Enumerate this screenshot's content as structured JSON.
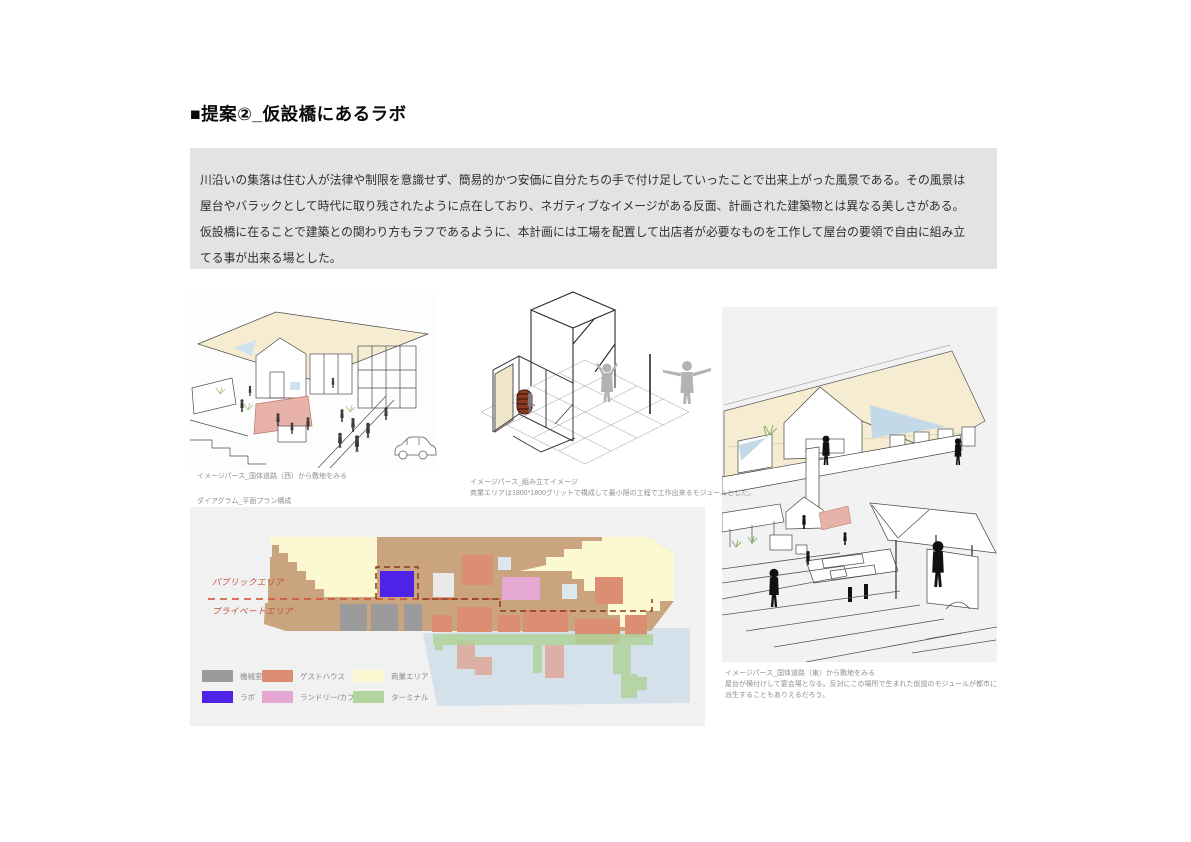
{
  "page": {
    "title": "■提案②_仮設橋にあるラボ"
  },
  "intro": {
    "lines": [
      "川沿いの集落は住む人が法律や制限を意識せず、簡易的かつ安価に自分たちの手で付け足していったことで出来上がった風景である。その風景は",
      "屋台やバラックとして時代に取り残されたように点在しており、ネガティブなイメージがある反面、計画された建築物とは異なる美しさがある。",
      "仮設橋に在ることで建築との関わり方もラフであるように、本計画には工場を配置して出店者が必要なものを工作して屋台の要領で自由に組み立",
      "てる事が出来る場とした。"
    ]
  },
  "views": {
    "west": {
      "caption": "イメージパース_国体道路（西）から敷地をみる"
    },
    "assembly": {
      "caption": "イメージパース_組み立てイメージ",
      "note": "商業エリアは1800*1800グリットで構成して最小限の工程で工作出来るモジュールとした。"
    },
    "east": {
      "caption": "イメージパース_国体道路（東）から敷地をみる",
      "note": "屋台が横付けして宴会場となる。反対にこの場所で生まれた仮設のモジュールが都市に派生することもありえるだろう。"
    }
  },
  "diagram": {
    "caption": "ダイアグラム_平面プラン構成",
    "zones": {
      "public": "パブリックエリア",
      "private": "プライベートエリア"
    },
    "legend": [
      {
        "label": "機械室",
        "color": "#9b9b9b"
      },
      {
        "label": "ゲストハウス",
        "color": "#dc8e72"
      },
      {
        "label": "商業エリア",
        "color": "#fcf8d2"
      },
      {
        "label": "ラボ",
        "color": "#4f22e8"
      },
      {
        "label": "ランドリー/カフェ",
        "color": "#e5a8d3"
      },
      {
        "label": "ターミナル",
        "color": "#b0d49c"
      }
    ],
    "colors": {
      "deck": "#c9a47e",
      "water": "#d5e1ea",
      "commercial": "#fcf8d2",
      "lab": "#4f22e8",
      "machine": "#9b9b9b",
      "guesthouse": "#dc8e72",
      "guesthouse_light": "#e0a493",
      "laundry": "#e5a8d3",
      "terminal": "#b0d49c",
      "divider": "#d24a32",
      "boundary": "#8a3a1e"
    }
  }
}
